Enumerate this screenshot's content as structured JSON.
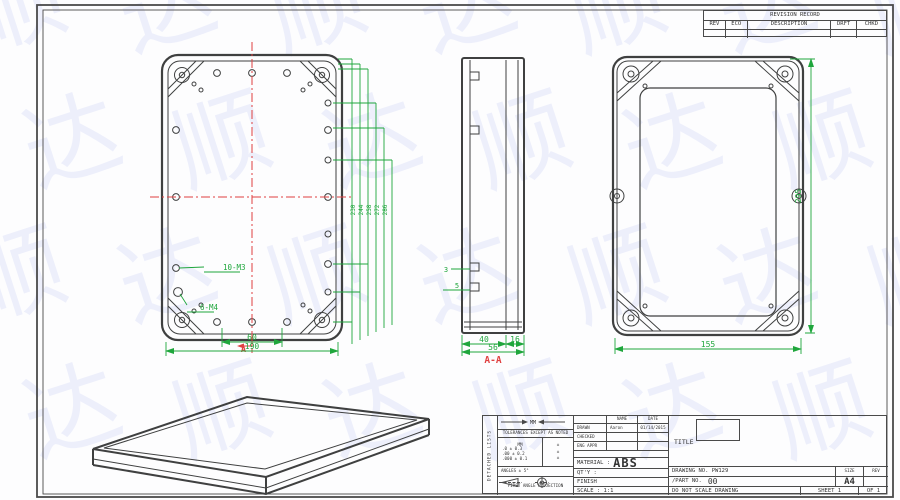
{
  "watermark": {
    "chars": [
      "顺",
      "达"
    ],
    "color": "rgba(125,138,228,0.12)"
  },
  "revision_table": {
    "title": "REVISION RECORD",
    "columns": [
      "REV",
      "ECO",
      "DESCRIPTION",
      "DRFT",
      "CHKD"
    ]
  },
  "front_view": {
    "dim_inner": "60",
    "dim_outer": "190",
    "thread_label_1": "10-M3",
    "thread_label_2": "6-M4",
    "section_letter": "A",
    "right_chain": [
      "230",
      "244",
      "258",
      "272",
      "286"
    ]
  },
  "side_view": {
    "tab_dim_1": "3",
    "tab_dim_2": "5",
    "dim_left": "40",
    "dim_right": "16",
    "dim_total": "56",
    "section_label": "A-A"
  },
  "back_view": {
    "dim_width": "155",
    "dim_height": "295"
  },
  "title_block": {
    "side_strip": "DETACHED LISTS",
    "symbol_note": "MM",
    "tolerance_note": "TOLERANCES EXCEPT AS NOTED",
    "units_label": "MM",
    "tolerances": [
      ".0 ± 0.3",
      ".00 ± 0.2",
      ".000 ± 0.1"
    ],
    "pm": "±",
    "angles": "ANGLES ± 5°",
    "projection": "FIRST ANGLE PROJECTION",
    "name_header": "NAME",
    "date_header": "DATE",
    "drawn_label": "DRAWN",
    "drawn_name": "Aaron",
    "drawn_date": "01/14/2015",
    "checked_label": "CHECKED",
    "eng_appr_label": "ENG APPR",
    "material_label": "MATERIAL :",
    "material_value": "ABS",
    "qty_label": "QT'Y :",
    "finish_label": "FINISH",
    "scale_label": "SCALE : 1:1",
    "title_label": "TITLE",
    "drawing_no": "DRAWING NO. PW129",
    "part_no_label": "/PART  NO.",
    "part_no_value": "00",
    "size_label": "SIZE",
    "size_value": "A4",
    "rev_label": "REV",
    "do_not_scale": "DO NOT SCALE DRAWING",
    "sheet": "SHEET 1",
    "of": "OF 1"
  }
}
